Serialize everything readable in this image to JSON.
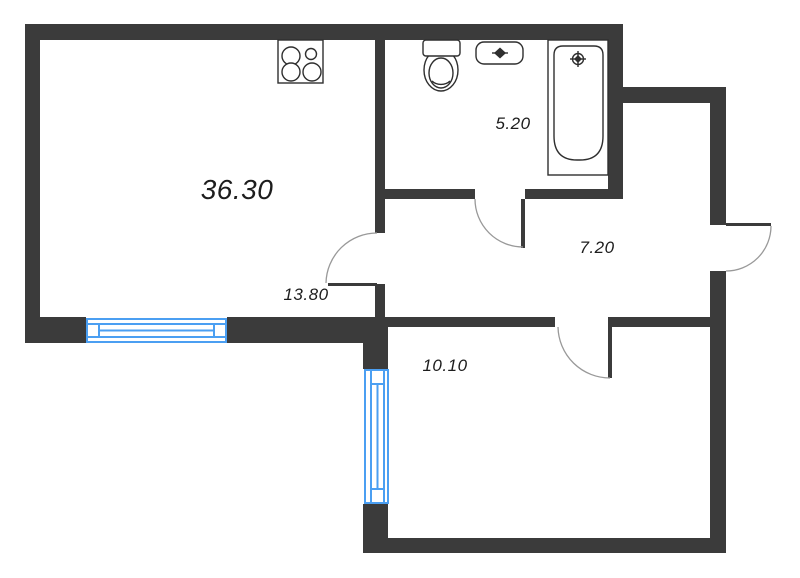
{
  "floorplan": {
    "total_area": "36.30",
    "rooms": [
      {
        "id": "living-kitchen",
        "area": "13.80"
      },
      {
        "id": "bathroom",
        "area": "5.20"
      },
      {
        "id": "hallway",
        "area": "7.20"
      },
      {
        "id": "bedroom",
        "area": "10.10"
      }
    ],
    "fixtures": [
      "stove-icon",
      "toilet-icon",
      "sink-icon",
      "bathtub-icon"
    ],
    "window_count": 2,
    "door_count": 4
  },
  "colors": {
    "wall": "#3b3b3b",
    "window": "#4b9ff2",
    "fixture_outline": "#2f2f2f",
    "door_arc": "#999999",
    "text": "#1d1d1d",
    "background": "#ffffff"
  }
}
